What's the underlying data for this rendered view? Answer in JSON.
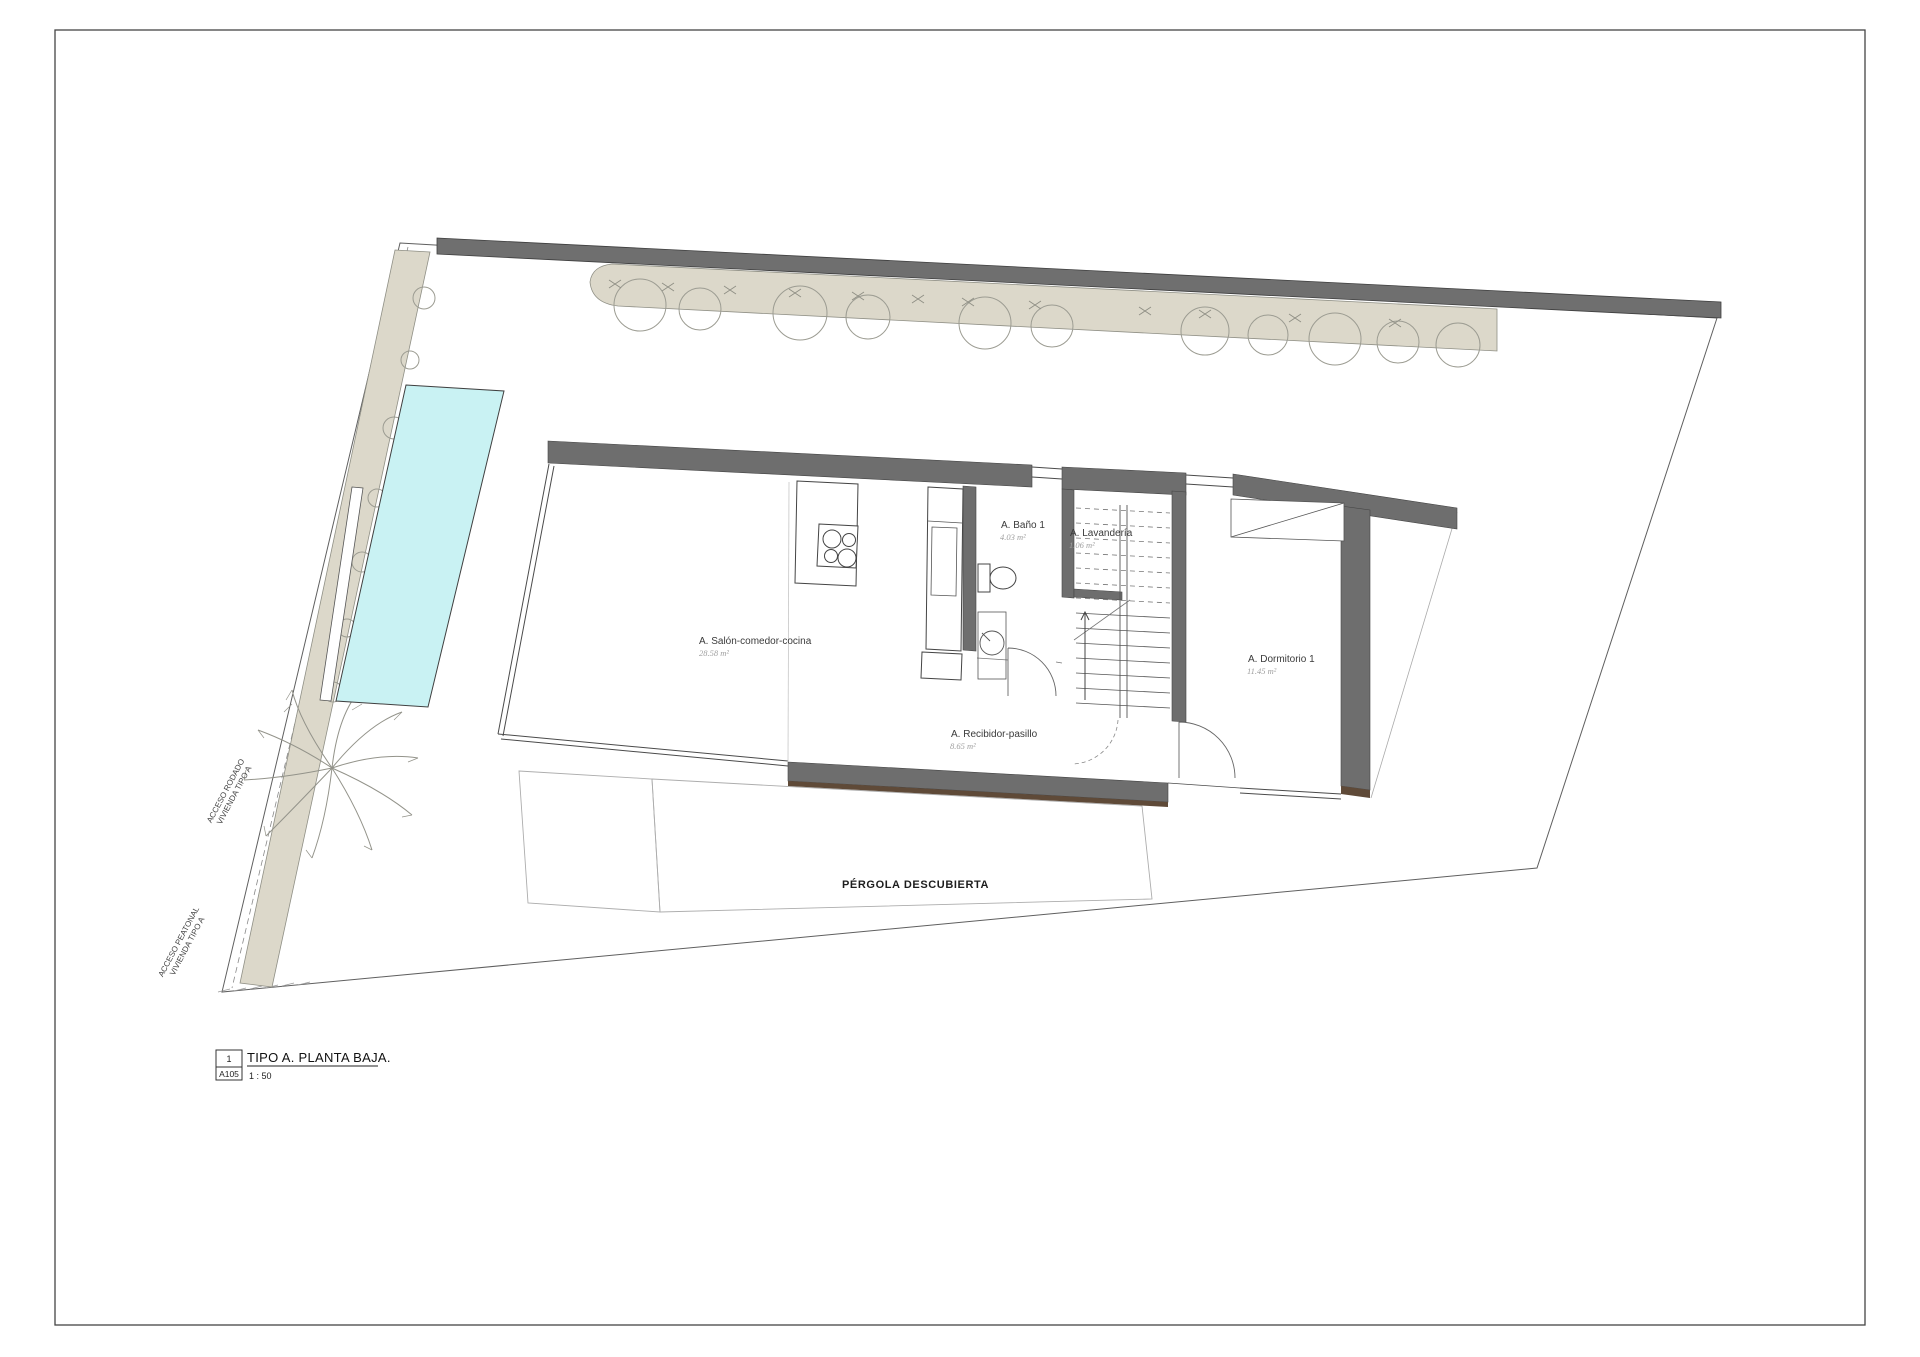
{
  "title_block": {
    "detail_number": "1",
    "sheet_code": "A105",
    "view_title": "TIPO A. PLANTA BAJA.",
    "scale": "1 : 50"
  },
  "rooms": [
    {
      "name": "A. Salón-comedor-cocina",
      "area": "28.58 m²"
    },
    {
      "name": "A. Baño 1",
      "area": "4.03 m²"
    },
    {
      "name": "A. Lavandería",
      "area": "1.06 m²"
    },
    {
      "name": "A. Recibidor-pasillo",
      "area": "8.65 m²"
    },
    {
      "name": "A. Dormitorio 1",
      "area": "11.45 m²"
    }
  ],
  "outdoor_labels": {
    "pergola": "PÉRGOLA DESCUBIERTA"
  },
  "access_labels": {
    "rodado_line1": "ACCESO RODADO",
    "rodado_line2": "VIVIENDA TIPO A",
    "peatonal_line1": "ACCESO PEATONAL",
    "peatonal_line2": "VIVIENDA TIPO A"
  },
  "colors": {
    "wall": "#6e6e6e",
    "fence": "#6f6f6f",
    "vegetation": "#dcd8ca",
    "pool": "#c9f2f3",
    "wood": "#5f4a38"
  }
}
